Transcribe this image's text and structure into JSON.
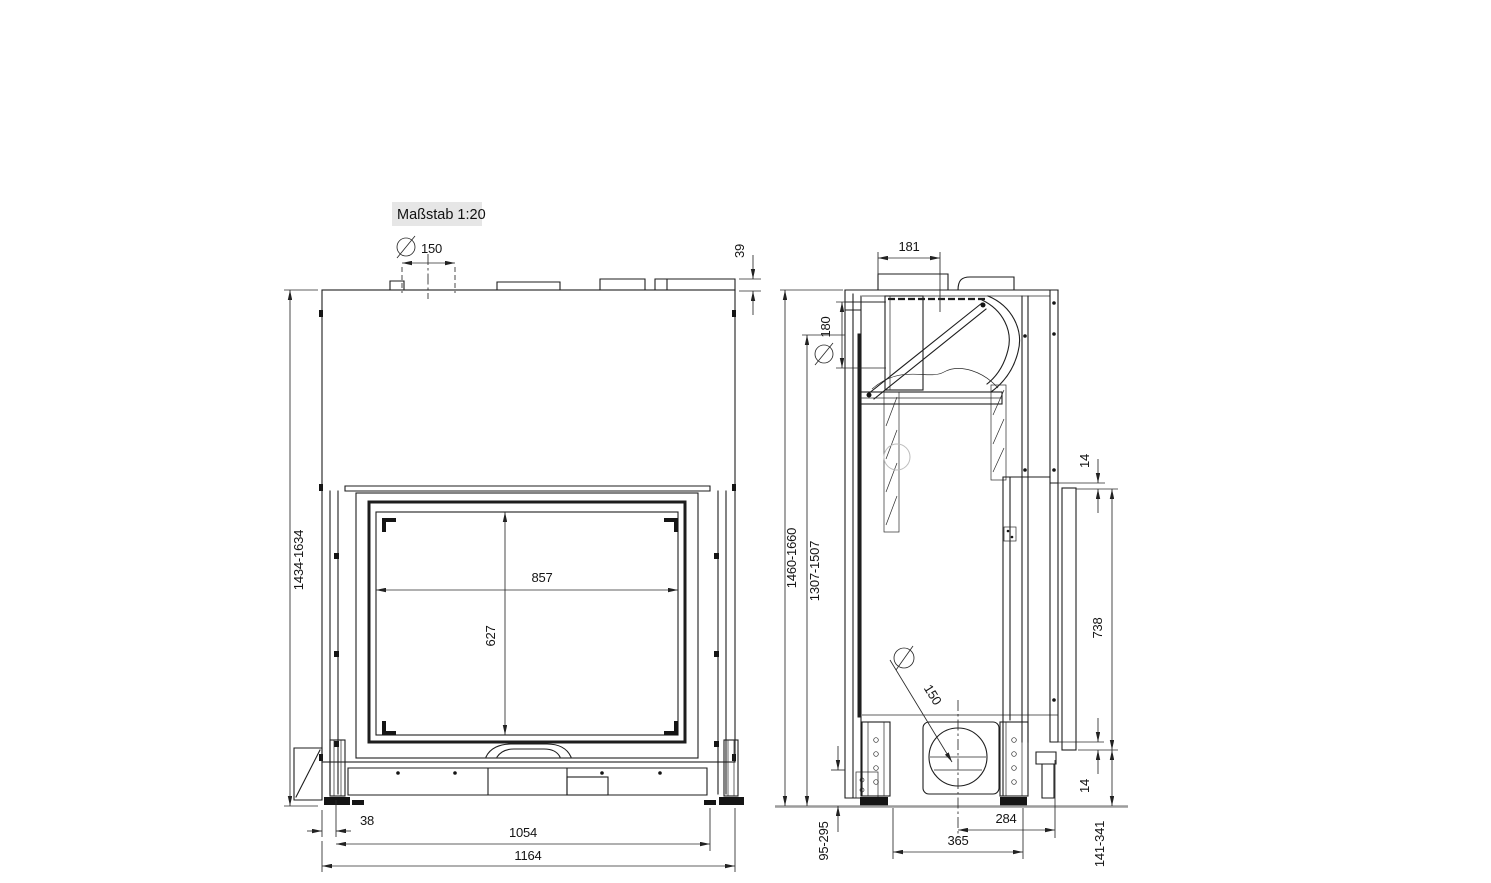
{
  "scale_badge": {
    "label": "Maßstab 1:20"
  },
  "front_view": {
    "dims": {
      "flue_diameter": "150",
      "collar_height": "39",
      "overall_height_range": "1434-1634",
      "glass_width": "857",
      "glass_height": "627",
      "foot_inset": "38",
      "feet_spacing": "1054",
      "overall_width": "1164"
    }
  },
  "side_view": {
    "dims": {
      "flue_center_offset": "181",
      "rear_outlet_diameter": "180",
      "overall_height_range": "1460-1660",
      "inner_height_range": "1307-1507",
      "shield_gap_top": "14",
      "heat_shield_height": "738",
      "shield_gap_bottom": "14",
      "air_intake_diameter": "150",
      "intake_center_to_rear": "284",
      "base_width": "365",
      "front_floor_clearance": "95-295",
      "rear_floor_clearance": "141-341"
    }
  }
}
